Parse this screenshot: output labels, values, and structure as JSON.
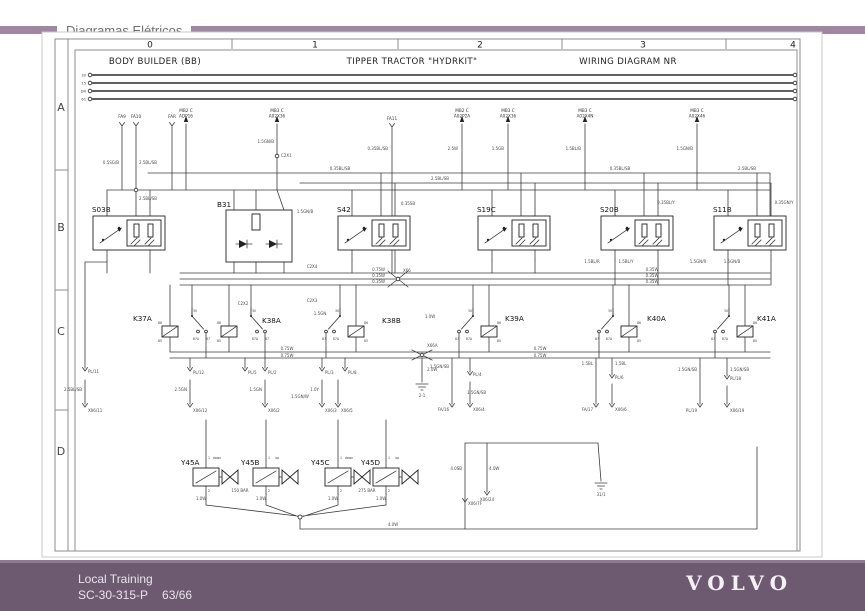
{
  "header": {
    "title": "Diagramas Elétricos"
  },
  "ruler": {
    "columns": [
      "0",
      "1",
      "2",
      "3",
      "4"
    ],
    "rows": [
      "A",
      "B",
      "C",
      "D"
    ]
  },
  "sections": {
    "s1": "BODY BUILDER (BB)",
    "s2": "TIPPER TRACTOR \"HYDRKIT\"",
    "s3": "WIRING DIAGRAM NR"
  },
  "diagram": {
    "bus_labels": [
      "30",
      "15",
      "DR",
      "61"
    ],
    "connectors": [
      {
        "l1": "FA9",
        "l2": ""
      },
      {
        "l1": "FA10",
        "l2": ""
      },
      {
        "l1": "FAR",
        "l2": ""
      },
      {
        "l1": "MB2 C",
        "l2": "ADP16"
      },
      {
        "l1": "MB3 C",
        "l2": "A02X36"
      },
      {
        "l1": "FA11",
        "l2": ""
      },
      {
        "l1": "MB2 C",
        "l2": "A02P2A"
      },
      {
        "l1": "MB3 C",
        "l2": "A02X36"
      },
      {
        "l1": "MB3 C",
        "l2": "A02X4N"
      },
      {
        "l1": "MB3 C",
        "l2": "A02X46"
      }
    ],
    "components": {
      "s03b": "S03B",
      "b31": "B31",
      "s42": "S42",
      "s19c": "S19C",
      "s20b": "S20B",
      "s11b": "S11B",
      "k37a": "K37A",
      "k38a": "K38A",
      "k38b": "K38B",
      "k39a": "K39A",
      "k40a": "K40A",
      "k41a": "K41A",
      "y45a": "Y45A",
      "y45b": "Y45B",
      "y45c": "Y45C",
      "y45d": "Y45D"
    },
    "relay_pins": {
      "p30": "30",
      "p85": "85",
      "p86": "86",
      "p87": "87",
      "p87a": "87A"
    },
    "valve_pins": {
      "p1": "1",
      "p2": "2"
    },
    "valve_notes": {
      "down": "down",
      "up": "up"
    },
    "pressure": {
      "b": "150 BAR",
      "d": "275 BAR"
    },
    "grounds": {
      "g1": "2-1",
      "g2": "31/1"
    },
    "wire_labels": [
      {
        "x": 119,
        "y": 164,
        "t": "0.5SG/B",
        "a": "e"
      },
      {
        "x": 139,
        "y": 164,
        "t": "2.5BL/SB",
        "a": "s"
      },
      {
        "x": 139,
        "y": 200,
        "t": "2.5BL/SB",
        "a": "s"
      },
      {
        "x": 274,
        "y": 143,
        "t": "1.5GN/B",
        "a": "e"
      },
      {
        "x": 281,
        "y": 157,
        "t": "C2X1",
        "a": "s"
      },
      {
        "x": 305,
        "y": 213,
        "t": "1.5GN/B"
      },
      {
        "x": 340,
        "y": 170,
        "t": "0.35BL/SB"
      },
      {
        "x": 440,
        "y": 180,
        "t": "2.5BL/SB"
      },
      {
        "x": 620,
        "y": 170,
        "t": "0.35BL/SB"
      },
      {
        "x": 747,
        "y": 170,
        "t": "2.5BL/SB"
      },
      {
        "x": 408,
        "y": 205,
        "t": "0.35SB"
      },
      {
        "x": 666,
        "y": 204,
        "t": "0.35BL/Y"
      },
      {
        "x": 784,
        "y": 204,
        "t": "0.35GN/Y"
      },
      {
        "x": 312,
        "y": 268,
        "t": "C2X4"
      },
      {
        "x": 385,
        "y": 271,
        "t": "0.75W",
        "a": "e"
      },
      {
        "x": 385,
        "y": 277,
        "t": "0.35W",
        "a": "e"
      },
      {
        "x": 385,
        "y": 283,
        "t": "0.35W",
        "a": "e"
      },
      {
        "x": 652,
        "y": 271,
        "t": "0.35W"
      },
      {
        "x": 652,
        "y": 277,
        "t": "0.35W"
      },
      {
        "x": 652,
        "y": 283,
        "t": "0.35W"
      },
      {
        "x": 403,
        "y": 272,
        "t": "X66",
        "a": "s"
      },
      {
        "x": 592,
        "y": 263,
        "t": "1.5BL/R"
      },
      {
        "x": 626,
        "y": 263,
        "t": "1.5BL/Y"
      },
      {
        "x": 698,
        "y": 263,
        "t": "1.5GN/R"
      },
      {
        "x": 732,
        "y": 263,
        "t": "1.5GN/B"
      },
      {
        "x": 243,
        "y": 305,
        "t": "C2X2"
      },
      {
        "x": 312,
        "y": 302,
        "t": "C2X3"
      },
      {
        "x": 320,
        "y": 315,
        "t": "1.5GN"
      },
      {
        "x": 430,
        "y": 318,
        "t": "1.0W"
      },
      {
        "x": 287,
        "y": 350,
        "t": "0.75W"
      },
      {
        "x": 287,
        "y": 357,
        "t": "0.75W"
      },
      {
        "x": 540,
        "y": 350,
        "t": "0.75W"
      },
      {
        "x": 540,
        "y": 357,
        "t": "0.75W"
      },
      {
        "x": 427,
        "y": 347,
        "t": "X66A",
        "a": "s"
      },
      {
        "x": 427,
        "y": 371,
        "t": "2.0W",
        "a": "s"
      },
      {
        "x": 88,
        "y": 373,
        "t": "PL/11",
        "a": "s"
      },
      {
        "x": 82,
        "y": 391,
        "t": "2.5BL/SB",
        "a": "e"
      },
      {
        "x": 88,
        "y": 412,
        "t": "X06/11",
        "a": "s"
      },
      {
        "x": 193,
        "y": 374,
        "t": "PL/12",
        "a": "s"
      },
      {
        "x": 187,
        "y": 391,
        "t": "2.5GN",
        "a": "e"
      },
      {
        "x": 193,
        "y": 412,
        "t": "X06/12",
        "a": "s"
      },
      {
        "x": 248,
        "y": 374,
        "t": "PL/5",
        "a": "s"
      },
      {
        "x": 268,
        "y": 374,
        "t": "PL/2",
        "a": "s"
      },
      {
        "x": 262,
        "y": 391,
        "t": "1.5GN",
        "a": "e"
      },
      {
        "x": 268,
        "y": 412,
        "t": "X06/2",
        "a": "s"
      },
      {
        "x": 300,
        "y": 398,
        "t": "1.5GN/W"
      },
      {
        "x": 325,
        "y": 374,
        "t": "PL/3",
        "a": "s"
      },
      {
        "x": 319,
        "y": 391,
        "t": "1.0Y",
        "a": "e"
      },
      {
        "x": 325,
        "y": 412,
        "t": "X06/3",
        "a": "s"
      },
      {
        "x": 348,
        "y": 374,
        "t": "PL/8",
        "a": "s"
      },
      {
        "x": 341,
        "y": 412,
        "t": "X06/5",
        "a": "s"
      },
      {
        "x": 449,
        "y": 368,
        "t": "1.5GN/SB",
        "a": "e"
      },
      {
        "x": 473,
        "y": 376,
        "t": "PL/4",
        "a": "s"
      },
      {
        "x": 467,
        "y": 394,
        "t": "1.5GN/SB",
        "a": "s"
      },
      {
        "x": 449,
        "y": 411,
        "t": "FA/16",
        "a": "e"
      },
      {
        "x": 473,
        "y": 411,
        "t": "X06/4",
        "a": "s"
      },
      {
        "x": 593,
        "y": 365,
        "t": "1.5BL",
        "a": "e"
      },
      {
        "x": 615,
        "y": 365,
        "t": "1.5BL",
        "a": "s"
      },
      {
        "x": 615,
        "y": 379,
        "t": "PL/6",
        "a": "s"
      },
      {
        "x": 593,
        "y": 411,
        "t": "FA/17",
        "a": "e"
      },
      {
        "x": 615,
        "y": 411,
        "t": "X06/6",
        "a": "s"
      },
      {
        "x": 697,
        "y": 371,
        "t": "1.5GN/SB",
        "a": "e"
      },
      {
        "x": 730,
        "y": 371,
        "t": "1.5GN/SB",
        "a": "s"
      },
      {
        "x": 730,
        "y": 380,
        "t": "PL/18",
        "a": "s"
      },
      {
        "x": 697,
        "y": 412,
        "t": "PL/19",
        "a": "e"
      },
      {
        "x": 730,
        "y": 412,
        "t": "X06/19",
        "a": "s"
      },
      {
        "x": 201,
        "y": 500,
        "t": "1.0W"
      },
      {
        "x": 261,
        "y": 500,
        "t": "1.0W"
      },
      {
        "x": 333,
        "y": 500,
        "t": "1.0W"
      },
      {
        "x": 381,
        "y": 500,
        "t": "1.0W"
      },
      {
        "x": 462,
        "y": 470,
        "t": "4.0SB",
        "a": "e"
      },
      {
        "x": 489,
        "y": 470,
        "t": "4.0W",
        "a": "s"
      },
      {
        "x": 487,
        "y": 501,
        "t": "X06/24"
      },
      {
        "x": 468,
        "y": 505,
        "t": "X06/7F",
        "a": "s"
      },
      {
        "x": 393,
        "y": 526,
        "t": "4.0W"
      },
      {
        "x": 388,
        "y": 150,
        "t": "0.35BL/SB",
        "a": "e"
      },
      {
        "x": 458,
        "y": 150,
        "t": "2.5W",
        "a": "e"
      },
      {
        "x": 504,
        "y": 150,
        "t": "1.5GB",
        "a": "e"
      },
      {
        "x": 581,
        "y": 150,
        "t": "1.5BL/B",
        "a": "e"
      },
      {
        "x": 693,
        "y": 150,
        "t": "1.5GN/B",
        "a": "e"
      }
    ]
  },
  "footer": {
    "line1": "Local Training",
    "line2": "SC-30-315-P",
    "page": "63/66",
    "brand": "VOLVO"
  }
}
